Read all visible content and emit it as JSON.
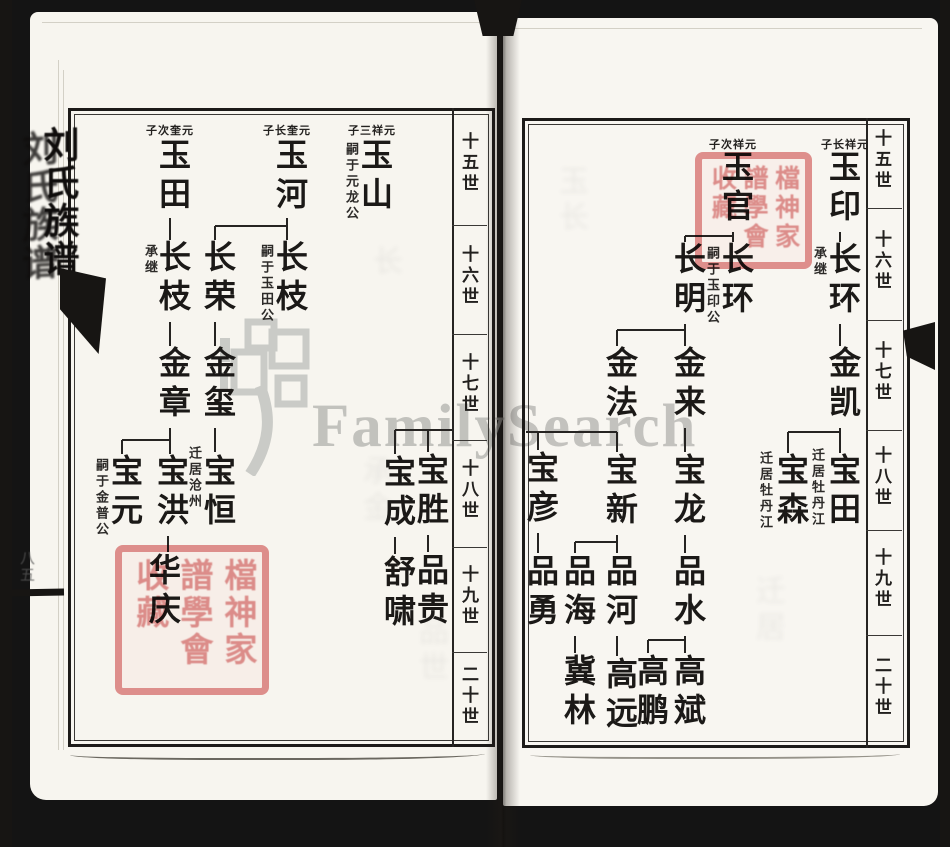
{
  "watermark": {
    "text": "FamilySearch"
  },
  "spine": {
    "title": "刘氏族谱",
    "page_marks": "八五"
  },
  "edge": {
    "title": "刘氏族谱"
  },
  "generation_labels": [
    "十五世",
    "十六世",
    "十七世",
    "十八世",
    "十九世",
    "二十世"
  ],
  "colors": {
    "seal_red": "#e28c8c",
    "watermark_gray": "#a3a3a0",
    "ink": "#1b1917",
    "paper": "#f7f5ef"
  },
  "seals": [
    {
      "x": 115,
      "y": 545,
      "w": 154,
      "h": 150,
      "font": 33,
      "columns": [
        [
          "檔",
          "神",
          "家"
        ],
        [
          "譜",
          "學",
          "會"
        ],
        [
          "收",
          "藏"
        ]
      ]
    },
    {
      "x": 695,
      "y": 152,
      "w": 117,
      "h": 117,
      "font": 25,
      "columns": [
        [
          "檔",
          "神",
          "家"
        ],
        [
          "譜",
          "學",
          "會"
        ],
        [
          "收",
          "藏"
        ]
      ]
    }
  ],
  "left_page": {
    "headers": [
      {
        "text": "子次奎元",
        "x": 170,
        "y": 122
      },
      {
        "text": "子长奎元",
        "x": 287,
        "y": 122
      },
      {
        "text": "子三祥元",
        "x": 372,
        "y": 122
      }
    ],
    "people": [
      {
        "name": "玉田",
        "x": 170,
        "y": 138
      },
      {
        "name": "玉河",
        "x": 287,
        "y": 138
      },
      {
        "name": "玉山",
        "x": 372,
        "y": 138,
        "ann": {
          "text": "嗣于元龙公",
          "x": 350,
          "y": 142
        }
      },
      {
        "name": "长枝",
        "x": 170,
        "y": 240,
        "ann": {
          "text": "承继",
          "x": 149,
          "y": 244
        }
      },
      {
        "name": "长荣",
        "x": 215,
        "y": 240
      },
      {
        "name": "长枝",
        "x": 287,
        "y": 240,
        "ann": {
          "text": "嗣于玉田公",
          "x": 265,
          "y": 244
        }
      },
      {
        "name": "金章",
        "x": 170,
        "y": 346
      },
      {
        "name": "金玺",
        "x": 215,
        "y": 346
      },
      {
        "name": "宝元",
        "x": 122,
        "y": 454,
        "ann": {
          "text": "嗣于金普公",
          "x": 100,
          "y": 458
        }
      },
      {
        "name": "宝洪",
        "x": 168,
        "y": 454
      },
      {
        "name": "宝恒",
        "x": 215,
        "y": 454,
        "ann": {
          "text": "迁居沧州",
          "x": 193,
          "y": 446
        }
      },
      {
        "name": "宝成",
        "x": 395,
        "y": 455
      },
      {
        "name": "宝胜",
        "x": 428,
        "y": 453
      },
      {
        "name": "华庆",
        "x": 160,
        "y": 553
      },
      {
        "name": "舒啸",
        "x": 395,
        "y": 555
      },
      {
        "name": "品贵",
        "x": 428,
        "y": 553
      }
    ],
    "lines": [
      [
        170,
        218,
        170,
        240
      ],
      [
        287,
        218,
        287,
        226
      ],
      [
        215,
        226,
        287,
        226
      ],
      [
        215,
        226,
        215,
        240
      ],
      [
        287,
        226,
        287,
        240
      ],
      [
        170,
        322,
        170,
        346
      ],
      [
        215,
        322,
        215,
        346
      ],
      [
        170,
        428,
        170,
        440
      ],
      [
        122,
        440,
        170,
        440
      ],
      [
        122,
        440,
        122,
        454
      ],
      [
        170,
        440,
        170,
        454
      ],
      [
        215,
        428,
        215,
        452
      ],
      [
        168,
        536,
        168,
        552
      ],
      [
        395,
        430,
        452,
        430
      ],
      [
        395,
        430,
        395,
        454
      ],
      [
        428,
        430,
        428,
        452
      ],
      [
        428,
        535,
        428,
        552
      ],
      [
        395,
        537,
        395,
        554
      ]
    ],
    "frame": {
      "x1": 68,
      "y1": 108,
      "x2": 495,
      "y2": 747
    },
    "gen_col": {
      "border_x": 452,
      "label_x": 471,
      "label_centers": [
        166,
        279,
        387,
        493,
        599,
        699
      ],
      "dividers": [
        225,
        334,
        440,
        547,
        652
      ]
    }
  },
  "right_page": {
    "headers": [
      {
        "text": "子次祥元",
        "x": 733,
        "y": 136
      },
      {
        "text": "子长祥元",
        "x": 845,
        "y": 136
      }
    ],
    "people": [
      {
        "name": "玉印",
        "x": 840,
        "y": 150
      },
      {
        "name": "玉官",
        "x": 733,
        "y": 150
      },
      {
        "name": "长环",
        "x": 840,
        "y": 242,
        "ann": {
          "text": "承继",
          "x": 818,
          "y": 246
        }
      },
      {
        "name": "长环",
        "x": 733,
        "y": 242,
        "ann": {
          "text": "嗣于玉印公",
          "x": 711,
          "y": 246
        }
      },
      {
        "name": "长明",
        "x": 685,
        "y": 242
      },
      {
        "name": "金凯",
        "x": 840,
        "y": 346
      },
      {
        "name": "金来",
        "x": 685,
        "y": 346
      },
      {
        "name": "金法",
        "x": 617,
        "y": 346
      },
      {
        "name": "宝田",
        "x": 840,
        "y": 453,
        "ann": {
          "text": "迁居牡丹江",
          "x": 816,
          "y": 448
        }
      },
      {
        "name": "宝森",
        "x": 788,
        "y": 453,
        "ann": {
          "text": "迁居牡丹江",
          "x": 764,
          "y": 451
        }
      },
      {
        "name": "宝龙",
        "x": 685,
        "y": 453
      },
      {
        "name": "宝新",
        "x": 617,
        "y": 453
      },
      {
        "name": "宝彦",
        "x": 538,
        "y": 451
      },
      {
        "name": "品水",
        "x": 685,
        "y": 554
      },
      {
        "name": "品河",
        "x": 617,
        "y": 554
      },
      {
        "name": "品海",
        "x": 575,
        "y": 554
      },
      {
        "name": "品勇",
        "x": 538,
        "y": 554
      },
      {
        "name": "高斌",
        "x": 685,
        "y": 654
      },
      {
        "name": "高鹏",
        "x": 648,
        "y": 654
      },
      {
        "name": "高远",
        "x": 617,
        "y": 657
      },
      {
        "name": "冀林",
        "x": 575,
        "y": 654
      }
    ],
    "lines": [
      [
        840,
        232,
        840,
        242
      ],
      [
        840,
        324,
        840,
        346
      ],
      [
        840,
        428,
        840,
        432
      ],
      [
        788,
        432,
        840,
        432
      ],
      [
        788,
        432,
        788,
        453
      ],
      [
        840,
        432,
        840,
        453
      ],
      [
        733,
        232,
        733,
        236
      ],
      [
        685,
        236,
        733,
        236
      ],
      [
        685,
        236,
        685,
        242
      ],
      [
        733,
        236,
        733,
        242
      ],
      [
        685,
        324,
        685,
        330
      ],
      [
        617,
        330,
        685,
        330
      ],
      [
        617,
        330,
        617,
        346
      ],
      [
        685,
        330,
        685,
        346
      ],
      [
        685,
        428,
        685,
        452
      ],
      [
        526,
        432,
        617,
        432
      ],
      [
        538,
        432,
        538,
        450
      ],
      [
        617,
        432,
        617,
        452
      ],
      [
        685,
        535,
        685,
        553
      ],
      [
        685,
        636,
        685,
        640
      ],
      [
        648,
        640,
        685,
        640
      ],
      [
        648,
        640,
        648,
        653
      ],
      [
        685,
        640,
        685,
        653
      ],
      [
        617,
        535,
        617,
        542
      ],
      [
        575,
        542,
        617,
        542
      ],
      [
        575,
        542,
        575,
        553
      ],
      [
        617,
        542,
        617,
        553
      ],
      [
        538,
        533,
        538,
        553
      ],
      [
        617,
        636,
        617,
        656
      ],
      [
        575,
        636,
        575,
        653
      ]
    ],
    "frame": {
      "x1": 522,
      "y1": 118,
      "x2": 910,
      "y2": 748
    },
    "gen_col": {
      "border_x": 866,
      "label_x": 884,
      "label_centers": [
        163,
        264,
        375,
        480,
        582,
        690
      ],
      "dividers": [
        208,
        320,
        430,
        530,
        635
      ]
    }
  },
  "ghost_marks": [
    {
      "x": 352,
      "y": 455,
      "text": "承金"
    },
    {
      "x": 408,
      "y": 615,
      "text": "品世"
    },
    {
      "x": 548,
      "y": 165,
      "text": "玉长"
    },
    {
      "x": 745,
      "y": 575,
      "text": "迁居"
    },
    {
      "x": 362,
      "y": 245,
      "text": "长"
    }
  ]
}
